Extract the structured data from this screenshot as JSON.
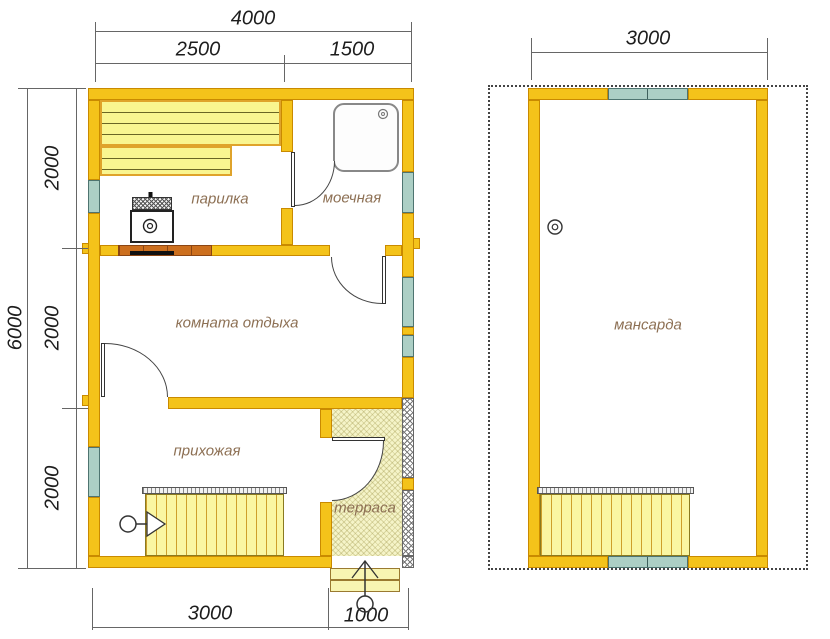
{
  "floor1": {
    "rooms": {
      "parilka": "парилка",
      "moechnaya": "моечная",
      "komnata": "комната отдыха",
      "prihozhaya": "прихожая",
      "terrasa": "терраса"
    },
    "dims": {
      "width_total": "4000",
      "width_left": "2500",
      "width_right": "1500",
      "height_total": "6000",
      "height_seg1": "2000",
      "height_seg2": "2000",
      "height_seg3": "2000",
      "bottom_main": "3000",
      "bottom_porch": "1000"
    }
  },
  "floor2": {
    "rooms": {
      "mansarda": "мансарда"
    },
    "dims": {
      "width_total": "3000"
    }
  },
  "icons": {
    "chimney": "double-circle",
    "shower_drain": "double-circle",
    "stove_heater": "double-circle-in-box",
    "stair_direction": "circle-line-arrowhead",
    "entrance": "circle-line-arrowhead"
  },
  "colors": {
    "wall_fill": "#F4C31A",
    "wall_outline": "#C98A00",
    "window_fill": "#ACCFC5",
    "bench_fill": "#F9F590",
    "stair_fill": "#FAF6A2",
    "terrace_floor": "#F5F4C8",
    "firebrick": "#CC6F1E",
    "room_label": "#8D7054",
    "dimension_text": "#1D1D1D"
  }
}
